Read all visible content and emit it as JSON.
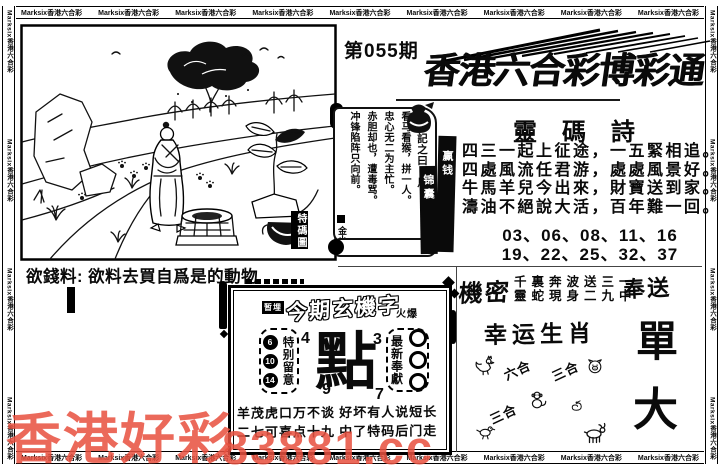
{
  "border": {
    "marquee_text": "Marksix香港六合彩"
  },
  "header": {
    "issue_label": "第055期",
    "title": "香港六合彩博彩通"
  },
  "art": {
    "seal": "特碼圖",
    "caption_label": "欲錢料:",
    "caption_text": "欲料去買自爲是的動物",
    "scene_icons": [
      "tree",
      "rocks",
      "horizon-trees",
      "birds",
      "person",
      "well",
      "plant",
      "paw-prints",
      "grass",
      "teapot"
    ]
  },
  "scroll": {
    "intro": "一字記之曰：馬",
    "lines": [
      "看马看猴，拼一人。",
      "忠心无二为主忙。",
      "赤胆却也，遭毒骂。",
      "冲锋陷阵只向前。"
    ],
    "signature": "金小姐",
    "tag_right": "赢钱",
    "tag_left": "锦囊"
  },
  "poem": {
    "title": "靈碼詩",
    "lines": [
      "四三一起上征途，一五緊相追。",
      "四處風流任君游，處處風景好。",
      "牛馬羊兒今出來，財寶送到家。",
      "濤油不絕說大活，百年難一回。"
    ],
    "numbers": [
      "03、06、08、11、16",
      "19、22、25、32、37"
    ]
  },
  "secret": {
    "label": "機密",
    "line1": "千裏奔波送三一",
    "line2": "靈蛇現身二九中",
    "gift": "奉送"
  },
  "zodiac": {
    "title": "幸运生肖",
    "labels": [
      "六合",
      "三合",
      "三合"
    ],
    "icons": [
      "rooster-icon",
      "pig-icon",
      "monkey-icon",
      "snake-icon",
      "bird-icon",
      "goat-icon"
    ]
  },
  "side_chars": {
    "top": "單",
    "bottom": "大"
  },
  "mystery": {
    "tag": "暂埋",
    "title": "今期玄機字",
    "hot": "火爆",
    "attention_label": "特别留意",
    "attention_numbers": [
      "6",
      "10",
      "14"
    ],
    "corner_numbers": {
      "top_left": "4",
      "bottom_left": "9",
      "top_right": "3",
      "bottom_right": "7"
    },
    "main_char": "點",
    "latest_label": "最新奉獻",
    "verses": [
      "羊茂虎口万不谈 好坏有人说短长",
      "二七可喜点十九 中了特码后门走"
    ]
  },
  "watermark": {
    "line1": "香港好彩",
    "line2": "83881.cc",
    "color": "#e85140"
  }
}
